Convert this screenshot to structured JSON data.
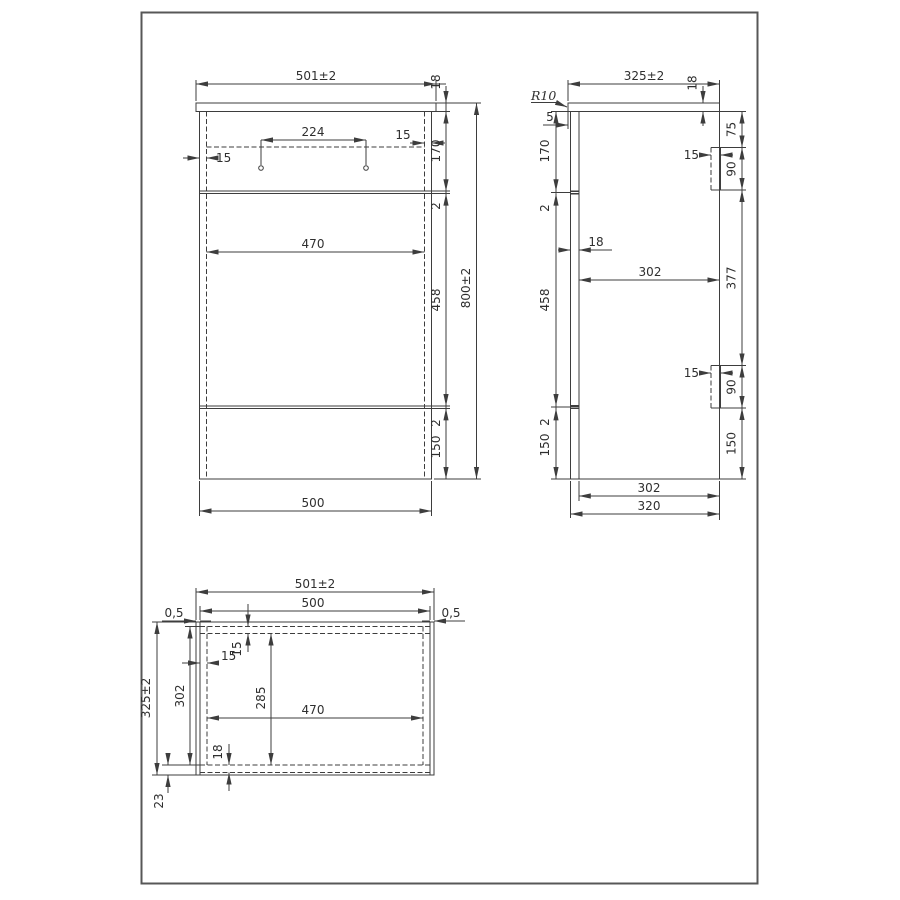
{
  "meta": {
    "drawing_type": "technical-dimension-drawing",
    "background": "#ffffff",
    "line_color": "#3d3d3d",
    "border_color": "#575757"
  },
  "views": {
    "front": {
      "dims": {
        "overall_width": "501±2",
        "worktop_thickness": "18",
        "handle_hole_spacing": "224",
        "right_inset": "15",
        "left_inset": "15",
        "upper_section_height": "170",
        "upper_gap": "2",
        "inner_width": "470",
        "middle_section_height": "458",
        "overall_height": "800±2",
        "lower_gap": "2",
        "lower_section_height": "150",
        "carcass_width": "500"
      }
    },
    "side": {
      "dims": {
        "overall_depth": "325±2",
        "worktop_thickness": "18",
        "corner_radius": "R10",
        "back_overhang": "5",
        "upper_section_height": "170",
        "upper_gap": "2",
        "bracket_top_offset": "75",
        "upper_bracket_inset": "15",
        "upper_bracket_height": "90",
        "back_panel_thickness": "18",
        "inner_depth": "302",
        "bracket_spacing": "377",
        "middle_section_height": "458",
        "lower_gap": "2",
        "lower_section_height": "150",
        "lower_bracket_inset": "15",
        "lower_bracket_height": "90",
        "lower_right_section": "150",
        "inner_depth_bottom": "302",
        "carcass_depth": "320"
      }
    },
    "plan": {
      "dims": {
        "overall_width": "501±2",
        "carcass_width": "500",
        "left_gap": "0,5",
        "right_gap": "0,5",
        "front_panel_inset": "15",
        "side_inset": "15",
        "overall_depth": "325±2",
        "inner_depth": "302",
        "clear_inner_depth": "285",
        "inner_width": "470",
        "back_panel_thickness": "18",
        "back_assembly_depth": "23"
      }
    }
  }
}
